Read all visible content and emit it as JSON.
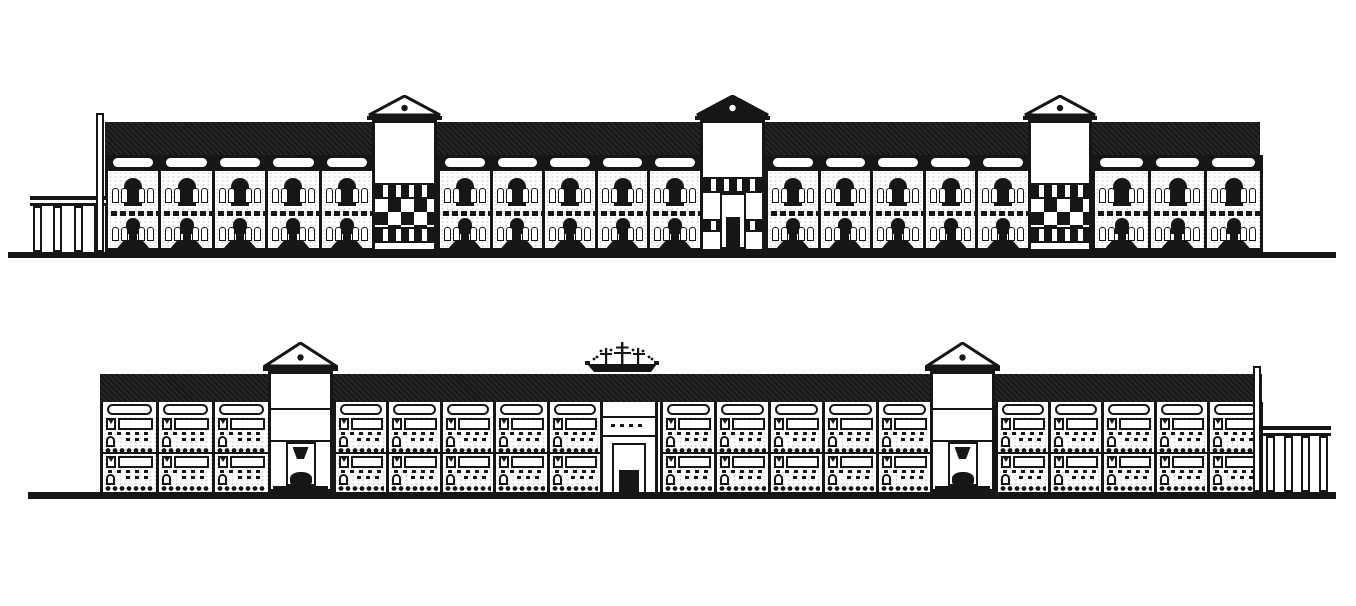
{
  "meta": {
    "drawing_type": "architectural-elevations",
    "ink_color": "#161616",
    "paper_color": "#ffffff",
    "elevation_count": 2
  },
  "elevations": [
    {
      "id": "upper-elevation",
      "storeys": 2,
      "ground": {
        "x": 8,
        "y": 252,
        "w": 1328,
        "h": 6
      },
      "roof": {
        "x": 105,
        "y": 122,
        "w": 1155,
        "h": 33
      },
      "facade": {
        "x": 105,
        "top": 155,
        "bottom": 252
      },
      "bay_style": "arched",
      "segments": [
        {
          "x": 105,
          "w": 267,
          "bays": 5
        },
        {
          "x": 437,
          "w": 263,
          "bays": 5
        },
        {
          "x": 765,
          "w": 263,
          "bays": 5
        },
        {
          "x": 1092,
          "w": 168,
          "bays": 3
        }
      ],
      "towers": [
        {
          "x": 372,
          "w": 65,
          "apex": 95,
          "base": 116,
          "variant": "checker",
          "roof_fill": "outline"
        },
        {
          "x": 700,
          "w": 65,
          "apex": 95,
          "base": 116,
          "variant": "door",
          "roof_fill": "solid"
        },
        {
          "x": 1028,
          "w": 64,
          "apex": 95,
          "base": 116,
          "variant": "checker",
          "roof_fill": "outline"
        }
      ],
      "posts": [
        {
          "x": 96,
          "y": 113,
          "w": 8,
          "h": 139
        }
      ],
      "colonnades": [
        {
          "x": 30,
          "w": 76,
          "top": 196,
          "columns": 4,
          "side": "left"
        }
      ],
      "pavilions": [],
      "ships": []
    },
    {
      "id": "lower-elevation",
      "storeys": 2,
      "ground": {
        "x": 28,
        "y": 492,
        "w": 1308,
        "h": 7
      },
      "roof": {
        "x": 100,
        "y": 374,
        "w": 1162,
        "h": 28
      },
      "facade": {
        "x": 100,
        "top": 402,
        "bottom": 492
      },
      "bay_style": "lintel",
      "segments": [
        {
          "x": 100,
          "w": 168,
          "bays": 3
        },
        {
          "x": 333,
          "w": 267,
          "bays": 5
        },
        {
          "x": 660,
          "w": 270,
          "bays": 5
        },
        {
          "x": 995,
          "w": 265,
          "bays": 5
        }
      ],
      "towers": [
        {
          "x": 268,
          "w": 65,
          "apex": 342,
          "base": 367,
          "variant": "plain-door",
          "roof_fill": "outline"
        },
        {
          "x": 930,
          "w": 65,
          "apex": 342,
          "base": 367,
          "variant": "plain-door",
          "roof_fill": "outline"
        }
      ],
      "posts": [
        {
          "x": 1253,
          "y": 366,
          "w": 8,
          "h": 126
        }
      ],
      "colonnades": [
        {
          "x": 1263,
          "w": 68,
          "top": 426,
          "columns": 4,
          "side": "right"
        }
      ],
      "pavilions": [
        {
          "x": 600,
          "w": 58,
          "top": 402,
          "bottom": 492
        }
      ],
      "ships": [
        {
          "x": 585,
          "y": 340,
          "w": 74,
          "h": 34
        }
      ]
    }
  ]
}
